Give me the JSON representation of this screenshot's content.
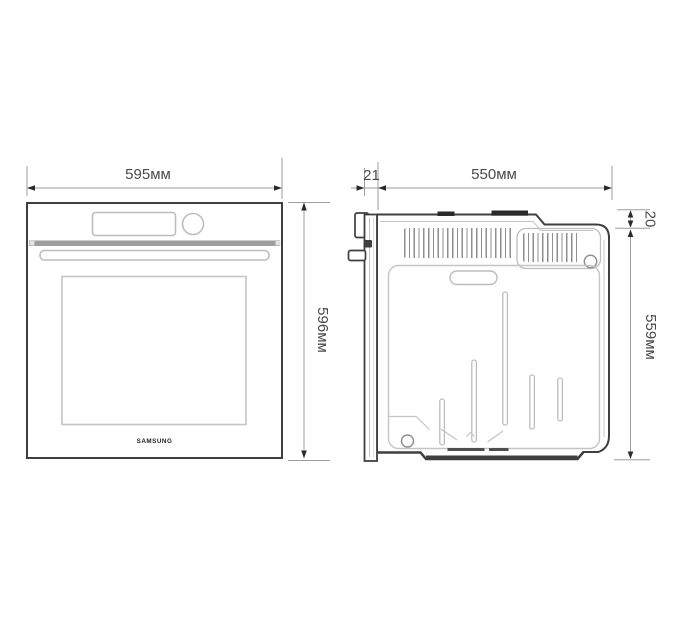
{
  "diagram": {
    "brand_logo": "SAMSUNG",
    "front_view": {
      "width_label": "595мм",
      "height_label": "596мм"
    },
    "side_view": {
      "door_depth_label": "21",
      "depth_label": "550мм",
      "top_clearance_label": "20",
      "height_label": "559мм"
    },
    "colors": {
      "outline_dark": "#3f3f3f",
      "outline_light": "#bdbdbd",
      "detail_light": "#c4c4c4",
      "dim_line": "#9e9e9e",
      "dim_text": "#4a4a4a",
      "arrow_fill": "#2a2a2a",
      "trim_fill": "#9e9e9e",
      "tab_fill": "#2a2a2a",
      "background": "#ffffff"
    }
  }
}
